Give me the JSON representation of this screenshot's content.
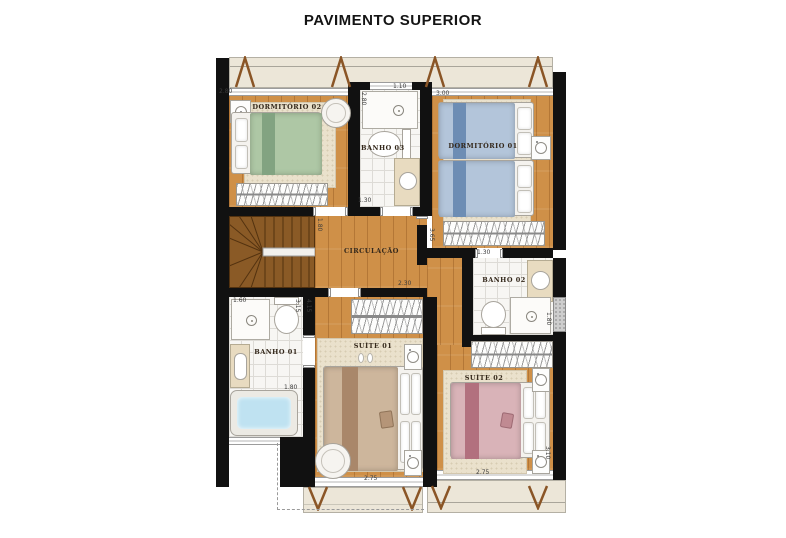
{
  "title": "PAVIMENTO SUPERIOR",
  "rooms": {
    "dormitorio02": {
      "label": "DORMITÓRIO 02"
    },
    "banho03": {
      "label": "BANHO 03"
    },
    "dormitorio01": {
      "label": "DORMITÓRIO 01"
    },
    "circulacao": {
      "label": "CIRCULAÇÃO"
    },
    "banho02": {
      "label": "BANHO 02"
    },
    "banho01": {
      "label": "BANHO 01"
    },
    "suite01": {
      "label": "SUÍTE 01"
    },
    "suite02": {
      "label": "SUÍTE 02"
    }
  },
  "dimensions": {
    "dorm02_width": "2.80",
    "banho03_width_top": "1.10",
    "banho03_depth": "2.80",
    "banho03_width_bottom": "1.30",
    "dorm01_width": "3.00",
    "circ_left_depth": "1.80",
    "circ_right_depth": "3.65",
    "circ_bottom_width": "2.30",
    "suite01_depth": "4.15",
    "banho02_width": "1.30",
    "banho02_depth": "1.80",
    "banho01_width": "1.60",
    "banho01_depth": "3.15",
    "banho01_inner_width": "1.80",
    "suite01_width": "2.75",
    "suite02_width": "2.75",
    "suite02_depth": "3.10"
  },
  "colors": {
    "wall": "#111111",
    "wood": "#cf9048",
    "tile": "#f7f6f3",
    "tileline": "#dddbd6",
    "rug": "#eae1cc",
    "balcony": "#ece6d8",
    "counter": "#e8dbc0",
    "stairs": "#8a5a26",
    "truss": "#8a5526",
    "water": "#bfe2f1",
    "bedgreen": "#aec7a5",
    "bedgreendark": "#82a381",
    "bedblue": "#b3c5da",
    "bedbluedark": "#6d8db4",
    "bedtan": "#cdb69c",
    "bedtandark": "#a9876a",
    "bedpink": "#d9b3b8",
    "bedpinkdark": "#b2707e",
    "labelcolor": "#33271a"
  }
}
